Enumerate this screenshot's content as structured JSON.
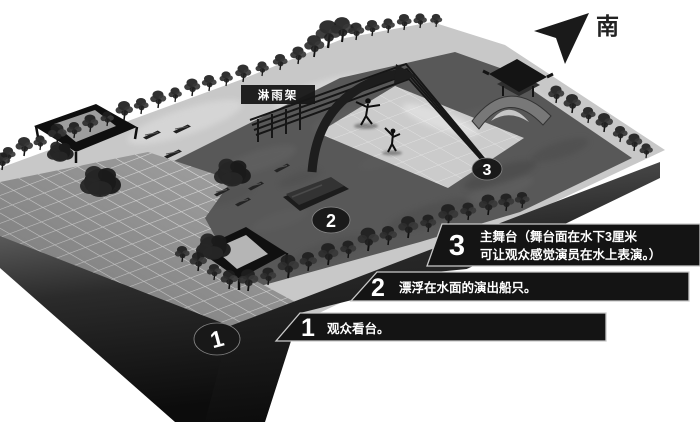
{
  "figure": {
    "compass": {
      "label": "南",
      "icon": "navigation-arrow-icon"
    },
    "frame_label": {
      "text": "淋雨架"
    },
    "markers": {
      "m1": "1",
      "m2": "2",
      "m3": "3"
    },
    "callouts": {
      "c3": {
        "num": "3",
        "line1": "主舞台（舞台面在水下3厘米",
        "line2": "可让观众感觉演员在水上表演。）"
      },
      "c2": {
        "num": "2",
        "line1": "漂浮在水面的演出船只。"
      },
      "c1": {
        "num": "1",
        "line1": "观众看台。"
      }
    },
    "colors": {
      "bar_fill": "#141414",
      "bar_outline": "#c9c9c9",
      "water": "#585858",
      "deck": "#c8c8c8",
      "tiles": "#a6a6a6",
      "text": "#ffffff"
    }
  }
}
